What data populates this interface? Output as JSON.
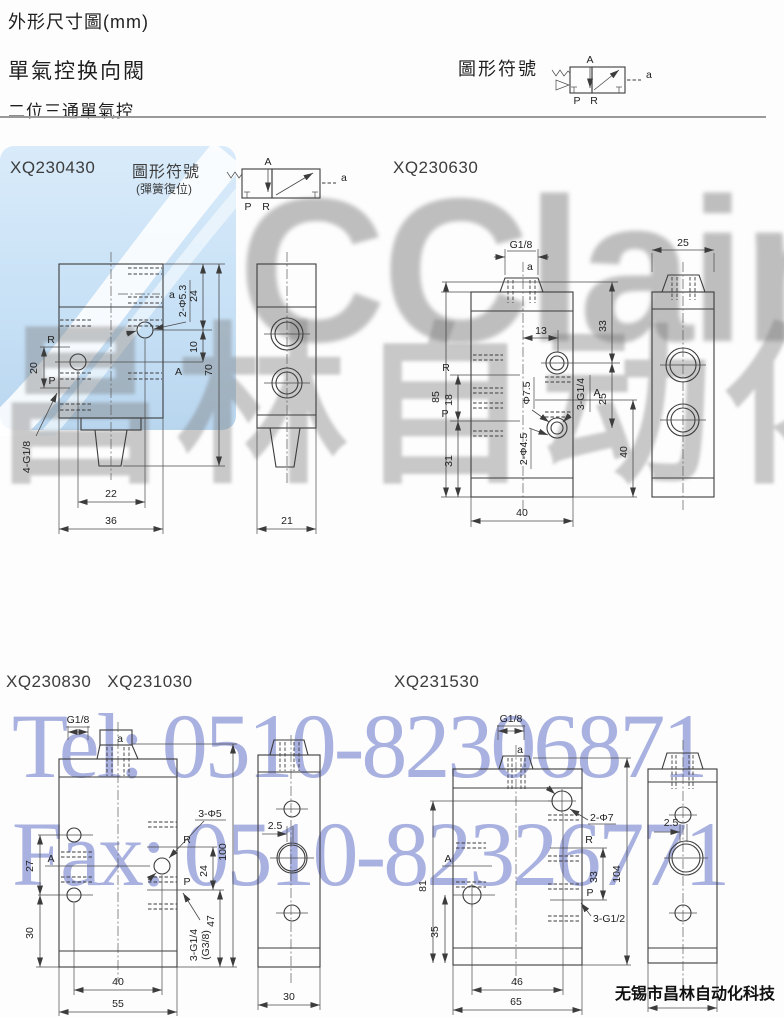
{
  "page": {
    "title": "外形尺寸圖(mm)",
    "product": "單氣控换向閥",
    "section": "二位三通單氣控",
    "footer": "无锡市昌林自动化科技"
  },
  "symbol": {
    "header_label": "圖形符號",
    "section_label": "圖形符號",
    "section_sub": "(彈簧復位)",
    "A": "A",
    "P": "P",
    "R": "R",
    "a": "a"
  },
  "models": {
    "m1": "XQ230430",
    "m2": "XQ230630",
    "m3a": "XQ230830",
    "m3b": "XQ231030",
    "m4": "XQ231530"
  },
  "watermarks": {
    "logo": "CClair",
    "brand": "昌林自动化",
    "tel": "Tel: 0510-82306871",
    "fax": "Fax: 0510-82326771",
    "accent_blue": "#c8e1f6",
    "tel_color": "#949ed8"
  },
  "d1f": {
    "a": "a",
    "A": "A",
    "R": "R",
    "P": "P",
    "d20": "20",
    "d24": "24",
    "d10": "10",
    "d70": "70",
    "d22": "22",
    "d36": "36",
    "hole": "2-Φ5.3",
    "thread": "4-G1/8"
  },
  "d1s": {
    "d21": "21"
  },
  "d2f": {
    "g": "G1/8",
    "a": "a",
    "A": "A",
    "R": "R",
    "P": "P",
    "d85": "85",
    "d18": "18",
    "d31": "31",
    "d13": "13",
    "d33": "33",
    "d25": "25",
    "d40r": "40",
    "d40b": "40",
    "dia": "Φ7.5",
    "hole": "2-Φ4.5",
    "thread": "3-G1/4"
  },
  "d2s": {
    "d25": "25"
  },
  "d3f": {
    "g": "G1/8",
    "a": "a",
    "A": "A",
    "R": "R",
    "P": "P",
    "d27": "27",
    "d30": "30",
    "d24": "24",
    "d47": "47",
    "d100": "100",
    "d40": "40",
    "d55": "55",
    "hole": "3-Φ5",
    "thread": "3-G1/4",
    "thread2": "(G3/8)"
  },
  "d3s": {
    "off": "2.5",
    "d30": "30"
  },
  "d4f": {
    "g": "G1/8",
    "a": "a",
    "A": "A",
    "R": "R",
    "P": "P",
    "d81": "81",
    "d35": "35",
    "d33": "33",
    "d104": "104",
    "d46": "46",
    "d65": "65",
    "hole": "2-Φ7",
    "thread": "3-G1/2"
  },
  "d4s": {
    "off": "2.5"
  }
}
